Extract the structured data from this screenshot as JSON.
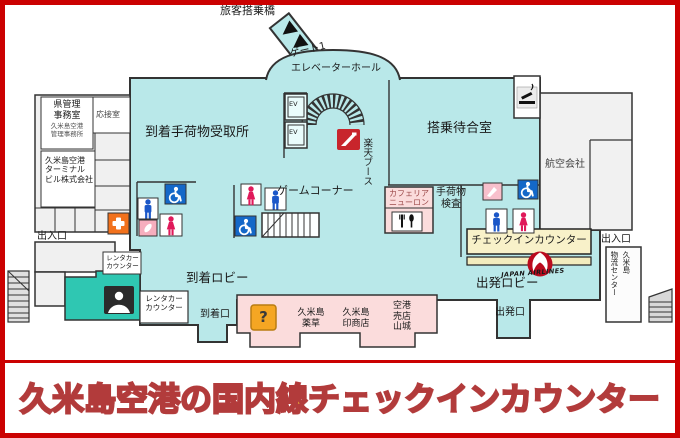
{
  "banner": {
    "title": "久米島空港の国内線チェックインカウンター"
  },
  "labels": {
    "boarding_bridge": "旅客搭乗橋",
    "gate1": "ゲート1",
    "elevator_hall": "エレベーターホール",
    "ev": "EV",
    "baggage_claim": "到着手荷物受取所",
    "waiting_room": "搭乗待合室",
    "airline_company": "航空会社",
    "game_corner": "ゲームコーナー",
    "rakuten_booth": "楽天ブース",
    "baggage_inspection": "手荷物\n検査",
    "cafeteria": "カフェリア\nニューロン",
    "checkin_counter": "チェックインカウンター",
    "jal_text": "JAPAN AIRLINES",
    "departure_lobby": "出発ロビー",
    "departure_gate": "出発口",
    "arrival_lobby": "到着ロビー",
    "arrival_gate": "到着口",
    "entrance_left": "出入口",
    "entrance_right": "出入口",
    "logistics_l1": "久米島",
    "logistics_l2": "物流センター",
    "rental_counter_small": "レンタカー\nカウンター",
    "rental_counter": "レンタカー\nカウンター",
    "info_mark": "?"
  },
  "offices": {
    "pref_office": "県管理\n事務室",
    "pref_office_sub": "久米島空港\n管理事務所",
    "reception_room": "応接室",
    "terminal_building_co": "久米島空港\nターミナル\nビル株式会社"
  },
  "shops": {
    "yakusou": "久米島\n薬草",
    "inshoten": "久米島\n印商店",
    "airport_shop": "空港\n売店\n山城"
  },
  "colors": {
    "frame_red": "#cb0101",
    "floor_cyan": "#b9e8e9",
    "rental_teal": "#2fc7b2",
    "shop_pink": "#fbdcdc",
    "checkin_yellow": "#f8f1c9",
    "gray_room": "#f0f0f0",
    "jal_red": "#bb0a1e",
    "first_aid_orange": "#f2711c",
    "male_blue": "#1b57c8",
    "female_red": "#e0195a",
    "wheelchair_blue": "#1468c8",
    "banner_text_yellow": "#ffe62e",
    "banner_outline_red": "#b23b3b"
  }
}
